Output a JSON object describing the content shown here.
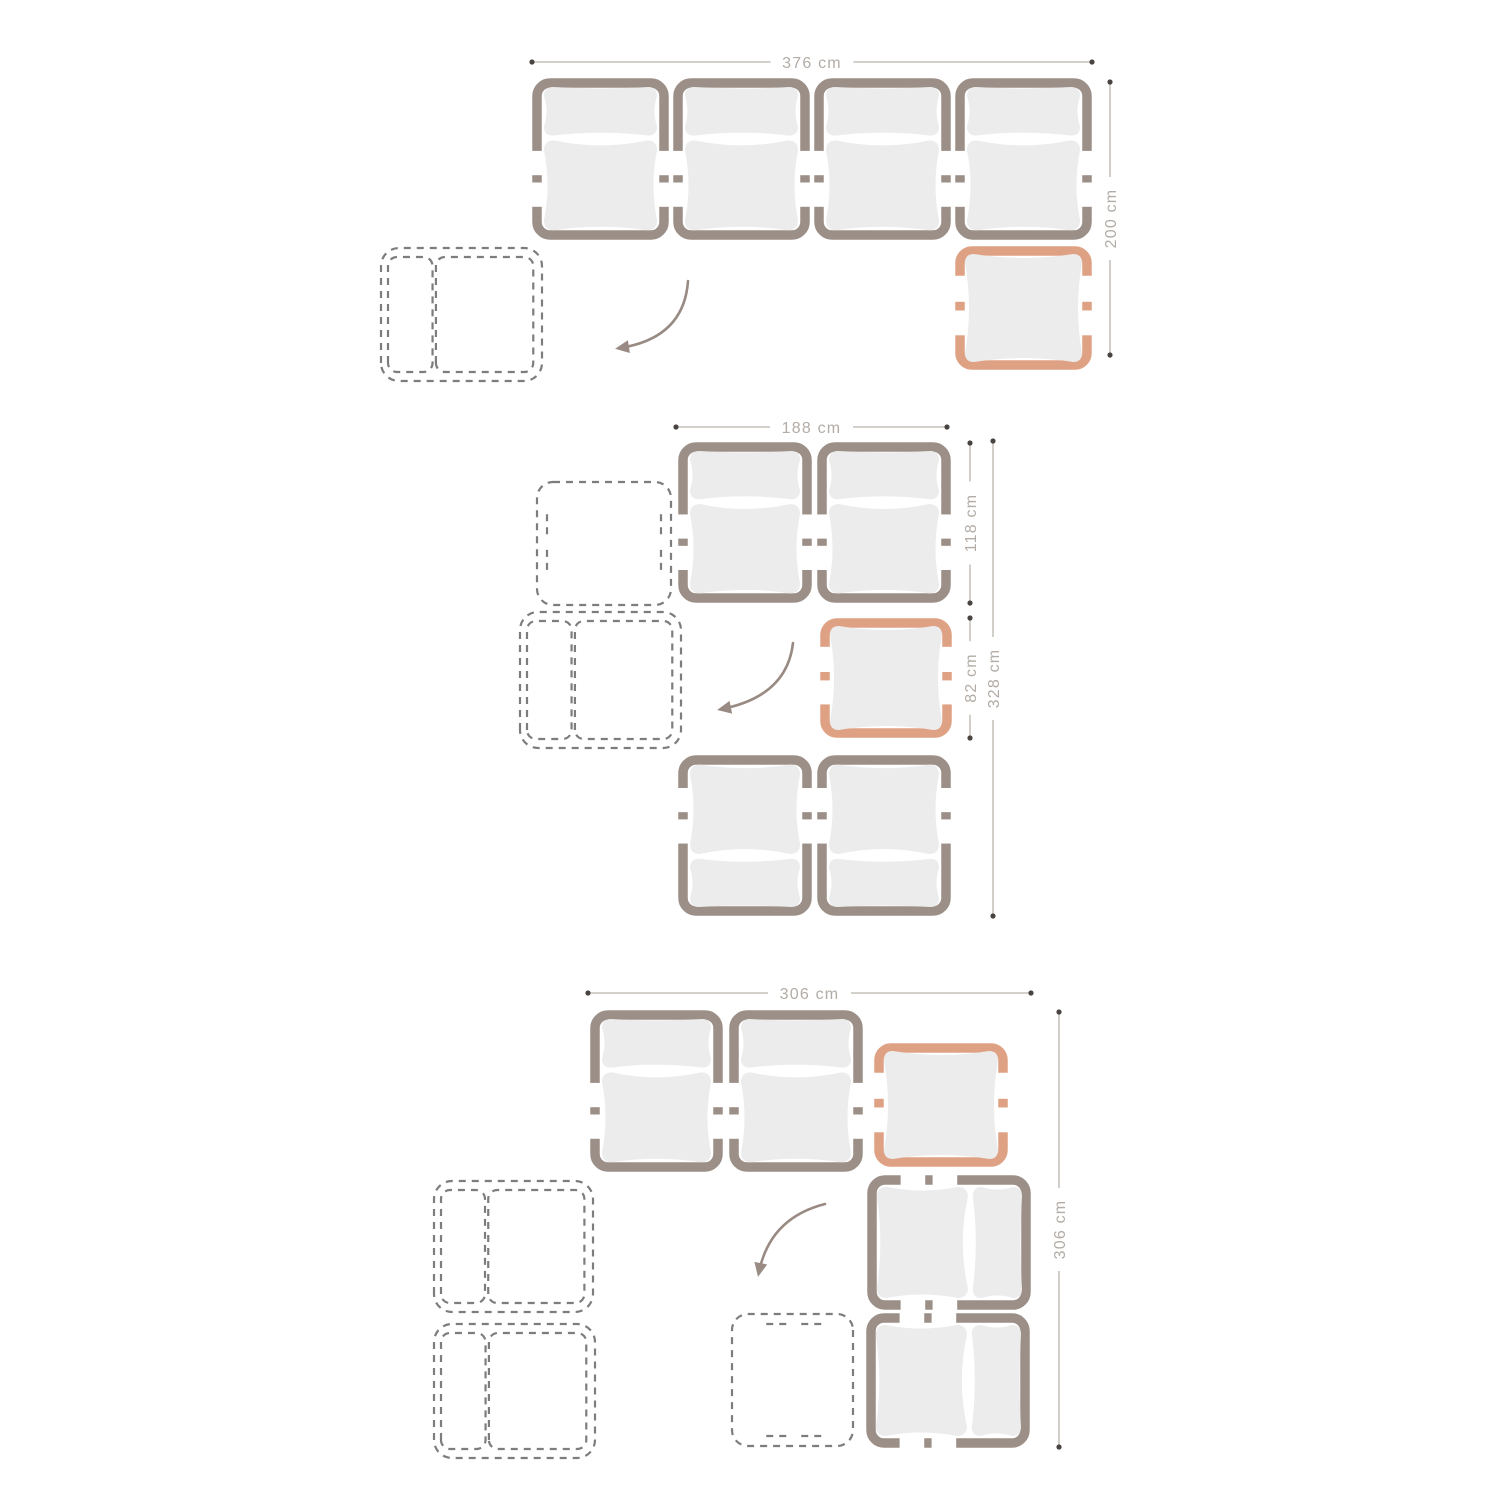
{
  "palette": {
    "background": "#ffffff",
    "module_frame": "#9c8f87",
    "cushion_fill": "#ececec",
    "accent_frame": "#dfa183",
    "dashed_outline": "#7d7d7d",
    "dimension_line": "#bab3ad",
    "dimension_text": "#b3aca6",
    "endpoint_dot": "#4a4441",
    "arrow": "#998b83"
  },
  "diagrams": [
    {
      "name": "configuration-1",
      "dimensions": [
        {
          "orient": "h",
          "label": "376 cm",
          "x1": 532,
          "x2": 1092,
          "y": 62
        },
        {
          "orient": "v",
          "label": "200 cm",
          "x": 1110,
          "y1": 82,
          "y2": 355
        }
      ],
      "modules": [
        {
          "kind": "sofa-module",
          "x": 532,
          "y": 78,
          "w": 137,
          "h": 162,
          "rot": 0
        },
        {
          "kind": "sofa-module",
          "x": 673,
          "y": 78,
          "w": 137,
          "h": 162,
          "rot": 0
        },
        {
          "kind": "sofa-module",
          "x": 814,
          "y": 78,
          "w": 137,
          "h": 162,
          "rot": 0
        },
        {
          "kind": "sofa-module",
          "x": 955,
          "y": 78,
          "w": 137,
          "h": 162,
          "rot": 0
        },
        {
          "kind": "table-module",
          "x": 955,
          "y": 246,
          "w": 137,
          "h": 124,
          "rot": 0
        },
        {
          "kind": "dashed-sofa-module",
          "x": 379,
          "y": 246,
          "w": 165,
          "h": 137,
          "rot": -90
        }
      ],
      "arrow": {
        "x0": 688,
        "y0": 281,
        "cx": 684,
        "cy": 338,
        "x1": 620,
        "y1": 348
      }
    },
    {
      "name": "configuration-2",
      "dimensions": [
        {
          "orient": "h",
          "label": "188 cm",
          "x1": 676,
          "x2": 947,
          "y": 427
        },
        {
          "orient": "v",
          "label": "118 cm",
          "x": 970,
          "y1": 443,
          "y2": 603
        },
        {
          "orient": "v",
          "label": "82 cm",
          "x": 970,
          "y1": 618,
          "y2": 738
        },
        {
          "orient": "v",
          "label": "328 cm",
          "x": 993,
          "y1": 441,
          "y2": 916
        }
      ],
      "modules": [
        {
          "kind": "sofa-module",
          "x": 678,
          "y": 442,
          "w": 134,
          "h": 161,
          "rot": 0
        },
        {
          "kind": "sofa-module",
          "x": 817,
          "y": 442,
          "w": 134,
          "h": 161,
          "rot": 0
        },
        {
          "kind": "table-module",
          "x": 820,
          "y": 618,
          "w": 132,
          "h": 120,
          "rot": 0
        },
        {
          "kind": "sofa-module",
          "x": 678,
          "y": 755,
          "w": 134,
          "h": 161,
          "rot": 180
        },
        {
          "kind": "sofa-module",
          "x": 817,
          "y": 755,
          "w": 134,
          "h": 161,
          "rot": 180
        },
        {
          "kind": "dashed-table-module",
          "x": 535,
          "y": 480,
          "w": 138,
          "h": 127,
          "rot": 0
        },
        {
          "kind": "dashed-sofa-module",
          "x": 518,
          "y": 610,
          "w": 165,
          "h": 140,
          "rot": -90
        }
      ],
      "arrow": {
        "x0": 793,
        "y0": 643,
        "cx": 787,
        "cy": 696,
        "x1": 722,
        "y1": 709
      }
    },
    {
      "name": "configuration-3",
      "dimensions": [
        {
          "orient": "h",
          "label": "306 cm",
          "x1": 588,
          "x2": 1031,
          "y": 993
        },
        {
          "orient": "v",
          "label": "306 cm",
          "x": 1059,
          "y1": 1012,
          "y2": 1447
        }
      ],
      "modules": [
        {
          "kind": "sofa-module",
          "x": 590,
          "y": 1010,
          "w": 133,
          "h": 162,
          "rot": 0
        },
        {
          "kind": "sofa-module",
          "x": 729,
          "y": 1010,
          "w": 134,
          "h": 162,
          "rot": 0
        },
        {
          "kind": "table-module",
          "x": 874,
          "y": 1043,
          "w": 134,
          "h": 124,
          "rot": 0
        },
        {
          "kind": "sofa-module",
          "x": 867,
          "y": 1175,
          "w": 164,
          "h": 135,
          "rot": 90
        },
        {
          "kind": "sofa-module",
          "x": 866,
          "y": 1313,
          "w": 164,
          "h": 135,
          "rot": 90
        },
        {
          "kind": "dashed-sofa-module",
          "x": 432,
          "y": 1179,
          "w": 163,
          "h": 135,
          "rot": -90
        },
        {
          "kind": "dashed-sofa-module",
          "x": 432,
          "y": 1322,
          "w": 165,
          "h": 138,
          "rot": -90
        },
        {
          "kind": "dashed-table-module",
          "x": 730,
          "y": 1312,
          "w": 125,
          "h": 136,
          "rot": 90
        }
      ],
      "arrow": {
        "x0": 825,
        "y0": 1204,
        "cx": 770,
        "cy": 1218,
        "x1": 759,
        "y1": 1272
      }
    }
  ]
}
